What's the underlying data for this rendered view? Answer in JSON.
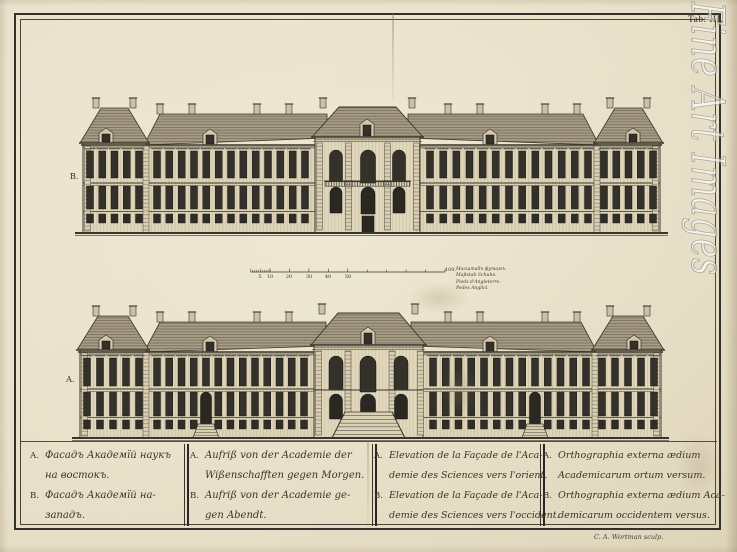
{
  "plate": {
    "tab_label": "Tab. III.",
    "credit": "C. A. Wortman sculp."
  },
  "watermark": {
    "text": "Fine Art Images"
  },
  "figures": {
    "top_label": "В.",
    "bottom_label": "А."
  },
  "scale_bar": {
    "tick_labels": [
      "5",
      "10",
      "20",
      "30",
      "40",
      "50"
    ],
    "end_label": "100.",
    "legend_lines": [
      "Масштабъ футамъ.",
      "Maßstab Schuhe.",
      "Pieds d'Angleterre.",
      "Pedes Anglici."
    ]
  },
  "captions": {
    "columns": [
      {
        "lang": "russian",
        "lines": [
          {
            "letter": "А.",
            "text": "Фасадъ Академїй наукъ"
          },
          {
            "letter": "",
            "text": "на востокъ."
          },
          {
            "letter": "В.",
            "text": "Фасадъ Академїй на-"
          },
          {
            "letter": "",
            "text": "западъ."
          }
        ]
      },
      {
        "lang": "german",
        "lines": [
          {
            "letter": "A.",
            "text": "Aufriß von der Academie der"
          },
          {
            "letter": "",
            "text": "Wißenschafften gegen Morgen."
          },
          {
            "letter": "B.",
            "text": "Aufriß von der Academie ge-"
          },
          {
            "letter": "",
            "text": "gen Abendt."
          }
        ]
      },
      {
        "lang": "french",
        "lines": [
          {
            "letter": "A.",
            "text": "Elevation de la Façade de l'Aca-"
          },
          {
            "letter": "",
            "text": "demie des Sciences vers l'orient."
          },
          {
            "letter": "B.",
            "text": "Elevation de la Façade de l'Aca-"
          },
          {
            "letter": "",
            "text": "demie des Sciences vers l'occident."
          }
        ]
      },
      {
        "lang": "latin",
        "lines": [
          {
            "letter": "A.",
            "text": "Orthographia externa ædium"
          },
          {
            "letter": "",
            "text": "Academicarum ortum versum."
          },
          {
            "letter": "B.",
            "text": "Orthographia externa ædium Aca-"
          },
          {
            "letter": "",
            "text": "demicarum occidentem versus."
          }
        ]
      }
    ]
  },
  "colors": {
    "paper": "#e6ddc5",
    "ink": "#3a352b",
    "roof": "#a79d86",
    "wall": "#ded5b9",
    "window": "#34302a"
  }
}
